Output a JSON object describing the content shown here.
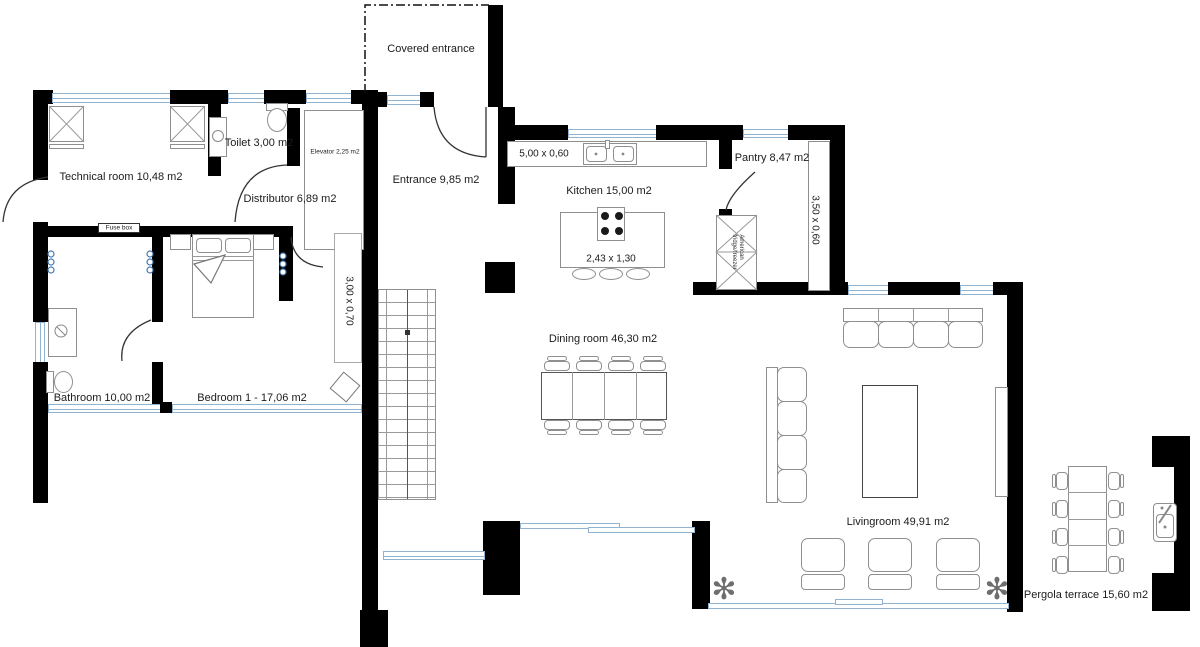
{
  "rooms": {
    "technical_room": {
      "label": "Technical room 10,48 m2"
    },
    "toilet": {
      "label": "Toilet 3,00 m2"
    },
    "elevator": {
      "label": "Elevator 2,25 m2"
    },
    "distributor": {
      "label": "Distributor 6,89 m2"
    },
    "covered_entrance": {
      "label": "Covered entrance"
    },
    "entrance": {
      "label": "Entrance 9,85 m2"
    },
    "kitchen": {
      "label": "Kitchen 15,00 m2"
    },
    "pantry": {
      "label": "Pantry 8,47 m2"
    },
    "dining_room": {
      "label": "Dining room 46,30 m2"
    },
    "bathroom": {
      "label": "Bathroom 10,00 m2"
    },
    "bedroom_1": {
      "label": "Bedroom 1 -  17,06 m2"
    },
    "livingroom": {
      "label": "Livingroom 49,91 m2"
    },
    "pergola_terrace": {
      "label": "Pergola terrace 15,60 m2"
    }
  },
  "dimensions": {
    "kitchen_counter": "5,00 x 0,60",
    "kitchen_island": "2,43 x 1,30",
    "pantry_counter": "3,50 x 0,60",
    "bedroom_closet": "3,00 x 0,70"
  },
  "fixtures": {
    "fuse_box": "Fuse box",
    "fridge_line1": "American",
    "fridge_line2": "fridge/freezer"
  },
  "colors": {
    "wall": "#000000",
    "window": "#8fb3d1",
    "furniture": "#8f8f8f",
    "switch_accent": "#4879b0",
    "text": "#1b1b1b"
  }
}
